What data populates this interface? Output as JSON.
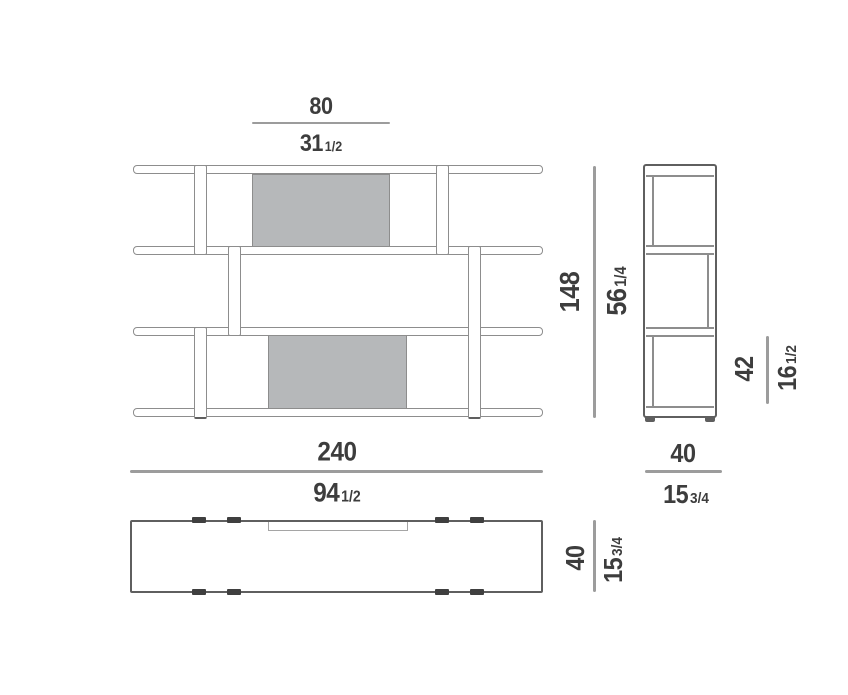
{
  "drawing_type": "furniture-dimension-drawing-shelving-unit",
  "dimensions": {
    "panel_width": {
      "cm": "80",
      "in_whole": "31",
      "in_frac": "1/2"
    },
    "overall_height": {
      "cm": "148",
      "in_whole": "56",
      "in_frac": "1/4"
    },
    "compartment_height": {
      "cm": "42",
      "in_whole": "16",
      "in_frac": "1/2"
    },
    "overall_width": {
      "cm": "240",
      "in_whole": "94",
      "in_frac": "1/2"
    },
    "side_depth": {
      "cm": "40",
      "in_whole": "15",
      "in_frac": "3/4"
    },
    "plan_depth": {
      "cm": "40",
      "in_whole": "15",
      "in_frac": "3/4"
    }
  },
  "colors": {
    "bg": "#ffffff",
    "outline": "#8d8d8d",
    "outline-dark": "#5f5f5f",
    "panel": "#b6b8ba",
    "dim": "#9c9c9c",
    "text": "#3d3d3d",
    "tick": "#3f3f3f"
  }
}
